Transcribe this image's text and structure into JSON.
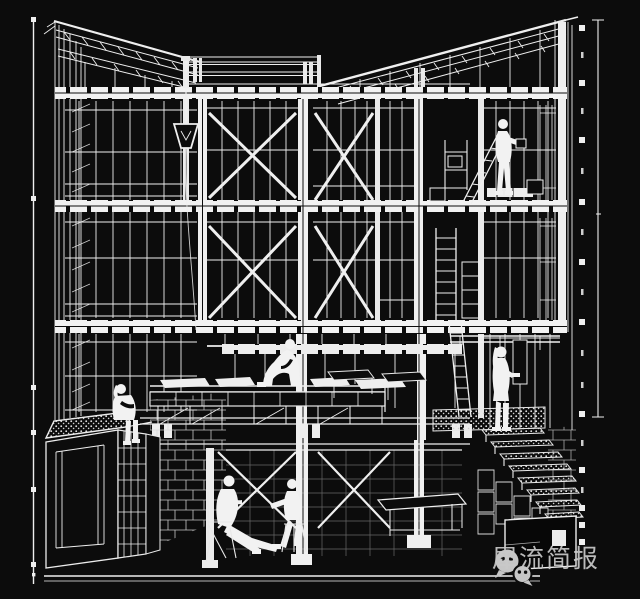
{
  "canvas": {
    "background_color": "#0c0c0c",
    "line_color": "#f0f0f0"
  },
  "watermark": {
    "text": "犀流简报",
    "icon": "wechat-icon",
    "text_color": "#c9c9c9",
    "icon_color": "#c6c6c6"
  }
}
